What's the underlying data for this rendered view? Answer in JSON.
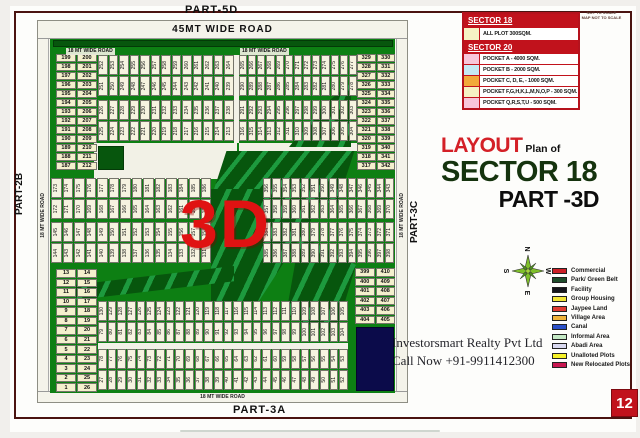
{
  "page": {
    "number": "12",
    "disclaimer_line1": "NOT TO SCALE",
    "disclaimer_line2": "MAP NOT TO SCALE"
  },
  "title": {
    "layout": "LAYOUT",
    "plan_of": "Plan of",
    "sector": "SECTOR 18",
    "part": "PART -3D"
  },
  "watermark": "3D",
  "contact": {
    "line1": "Investorsmart Realty Pvt Ltd",
    "line2": "Call Now +91-9911412300"
  },
  "roads": {
    "part_5d": "PART-5D",
    "part_2b": "PART-2B",
    "part_3c": "PART-3C",
    "part_3a": "PART-3A",
    "road_45": "45MT WIDE ROAD",
    "road_18_top_left": "18 MT WIDE ROAD",
    "road_18_top_right": "18 MT WIDE ROAD",
    "road_18_left": "18 MT WIDE ROAD",
    "road_18_right": "18 MT WIDE ROAD",
    "road_18_bottom": "18 MT WIDE ROAD"
  },
  "colors": {
    "map_green": "#0d7f13",
    "park_dark_green": "#07560d",
    "canal_navy": "#0b0b4a",
    "accent_red": "#c1121c",
    "border_maroon": "#4a1310"
  },
  "sector_tables": [
    {
      "header": "SECTOR 18",
      "rows": [
        {
          "color": "#f6f2c4",
          "label": "ALL PLOT  300SQM."
        }
      ]
    },
    {
      "header": "SECTOR 20",
      "rows": [
        {
          "color": "#f8c6da",
          "label": "POCKET A   -  4000 SQM."
        },
        {
          "color": "#c6e9f4",
          "label": "POCKET B   -  2000 SQM."
        },
        {
          "color": "#f2a93b",
          "label": "POCKET C, D, E, - 1000 SQM."
        },
        {
          "color": "#f6f2c4",
          "label": "POCKET  F,G,H,K,L,M,N,O,P  -  300 SQM."
        },
        {
          "color": "#f8c6da",
          "label": "POCKET Q,R,S,T,U   -  500 SQM."
        }
      ]
    }
  ],
  "legend": {
    "items": [
      {
        "label": "Commercial",
        "color": "#cc2027"
      },
      {
        "label": "Park/ Green Belt",
        "color": "#1e4d2b"
      },
      {
        "label": "Facility",
        "color": "#15151c"
      },
      {
        "label": "Group Housing",
        "color": "#f2e535"
      },
      {
        "label": "Jaypee Land",
        "color": "#e03a33"
      },
      {
        "label": "Village Area",
        "color": "#f0b43c"
      },
      {
        "label": "Canal",
        "color": "#2b50c8"
      },
      {
        "label": "Informal Area",
        "color": "#c4e9c5"
      },
      {
        "label": "Abadi Area",
        "color": "#d9d9f0"
      },
      {
        "label": "Unalloted Plots",
        "color": "#f5f128"
      },
      {
        "label": "New Relocated Plots",
        "color": "#c81750"
      }
    ]
  },
  "compass": {
    "n": "N",
    "e": "E",
    "s": "S",
    "w": "W"
  },
  "map": {
    "strips": [
      {
        "id": "tl1",
        "rows": [
          [
            252,
            253,
            254,
            255,
            256,
            257,
            258,
            259,
            260,
            261,
            262,
            263,
            264
          ],
          [
            251,
            250,
            249,
            248,
            247,
            246,
            245,
            244,
            243,
            242,
            241,
            240,
            239
          ]
        ]
      },
      {
        "id": "tr1",
        "rows": [
          [
            265,
            266,
            267,
            268,
            269,
            270,
            271,
            272,
            273,
            274,
            275,
            276,
            277
          ],
          [
            290,
            289,
            288,
            287,
            286,
            285,
            284,
            283,
            282,
            281,
            280,
            279,
            278
          ]
        ]
      },
      {
        "id": "tl2",
        "rows": [
          [
            226,
            227,
            228,
            229,
            230,
            231,
            232,
            233,
            234,
            235,
            236,
            237,
            238
          ],
          [
            225,
            224,
            223,
            222,
            221,
            220,
            219,
            218,
            217,
            216,
            215,
            214,
            213
          ]
        ]
      },
      {
        "id": "tr2",
        "rows": [
          [
            291,
            292,
            293,
            294,
            295,
            296,
            297,
            298,
            299,
            300,
            301,
            302,
            303
          ],
          [
            316,
            315,
            314,
            313,
            312,
            311,
            310,
            309,
            308,
            307,
            306,
            305,
            304
          ]
        ]
      },
      {
        "id": "ml1",
        "rows": [
          [
            173,
            174,
            175,
            176,
            177,
            178,
            179,
            180,
            181,
            182,
            183,
            184,
            185,
            186
          ],
          [
            172,
            171,
            170,
            169,
            168,
            167,
            166,
            165,
            164,
            163,
            162,
            161,
            160,
            159
          ]
        ]
      },
      {
        "id": "ml2",
        "rows": [
          [
            145,
            146,
            147,
            148,
            149,
            150,
            151,
            152,
            153,
            154,
            155,
            156,
            157,
            158
          ],
          [
            144,
            143,
            142,
            141,
            140,
            139,
            138,
            137,
            136,
            135,
            134,
            133,
            132,
            131
          ]
        ]
      },
      {
        "id": "mr1",
        "rows": [
          [
            356,
            355,
            354,
            353,
            352,
            351,
            350,
            349,
            348,
            347,
            346,
            345,
            344,
            343
          ],
          [
            357,
            358,
            359,
            360,
            361,
            362,
            363,
            364,
            365,
            366,
            367,
            368,
            369,
            370
          ]
        ]
      },
      {
        "id": "mr2",
        "rows": [
          [
            384,
            383,
            382,
            381,
            380,
            379,
            378,
            377,
            376,
            375,
            374,
            373,
            372,
            371
          ],
          [
            385,
            386,
            387,
            388,
            389,
            390,
            391,
            392,
            393,
            394,
            395,
            396,
            397,
            398
          ]
        ]
      },
      {
        "id": "bl1",
        "rows": [
          [
            130,
            129,
            128,
            127,
            126,
            125,
            124,
            123,
            122,
            121,
            120,
            119,
            118,
            117,
            116,
            115,
            114,
            113,
            112,
            111,
            110,
            109,
            108,
            107,
            106,
            105
          ],
          [
            79,
            80,
            81,
            82,
            83,
            84,
            85,
            86,
            87,
            88,
            89,
            90,
            91,
            92,
            93,
            94,
            95,
            96,
            97,
            98,
            99,
            100,
            101,
            102,
            103,
            104
          ]
        ]
      },
      {
        "id": "bl2",
        "rows": [
          [
            78,
            77,
            76,
            75,
            74,
            73,
            72,
            71,
            70,
            69,
            68,
            67,
            66,
            65,
            64,
            63,
            62,
            61,
            60,
            59,
            58,
            57,
            56,
            55,
            54,
            53
          ],
          [
            27,
            28,
            29,
            30,
            31,
            32,
            33,
            34,
            35,
            36,
            37,
            38,
            39,
            40,
            41,
            42,
            43,
            44,
            45,
            46,
            47,
            48,
            49,
            50,
            51,
            52
          ]
        ]
      }
    ],
    "pair_columns": [
      {
        "id": "pc-tl",
        "pairs": [
          [
            199,
            200
          ],
          [
            198,
            201
          ],
          [
            197,
            202
          ],
          [
            196,
            203
          ],
          [
            195,
            204
          ],
          [
            194,
            205
          ],
          [
            193,
            206
          ],
          [
            192,
            207
          ],
          [
            191,
            208
          ],
          [
            190,
            209
          ],
          [
            189,
            210
          ],
          [
            188,
            211
          ],
          [
            187,
            212
          ]
        ]
      },
      {
        "id": "pc-tr",
        "pairs": [
          [
            329,
            330
          ],
          [
            328,
            331
          ],
          [
            327,
            332
          ],
          [
            326,
            333
          ],
          [
            325,
            334
          ],
          [
            324,
            335
          ],
          [
            323,
            336
          ],
          [
            322,
            337
          ],
          [
            321,
            338
          ],
          [
            320,
            339
          ],
          [
            319,
            340
          ],
          [
            318,
            341
          ],
          [
            317,
            342
          ]
        ]
      },
      {
        "id": "pc-bl",
        "pairs": [
          [
            13,
            14
          ],
          [
            12,
            15
          ],
          [
            11,
            16
          ],
          [
            10,
            17
          ],
          [
            9,
            18
          ],
          [
            8,
            19
          ],
          [
            7,
            20
          ],
          [
            6,
            21
          ],
          [
            5,
            22
          ],
          [
            4,
            23
          ],
          [
            3,
            24
          ],
          [
            2,
            25
          ],
          [
            1,
            26
          ]
        ]
      },
      {
        "id": "pc-br",
        "pairs": [
          [
            399,
            410
          ],
          [
            400,
            409
          ],
          [
            401,
            408
          ],
          [
            402,
            407
          ],
          [
            403,
            406
          ],
          [
            404,
            405
          ]
        ]
      }
    ]
  }
}
